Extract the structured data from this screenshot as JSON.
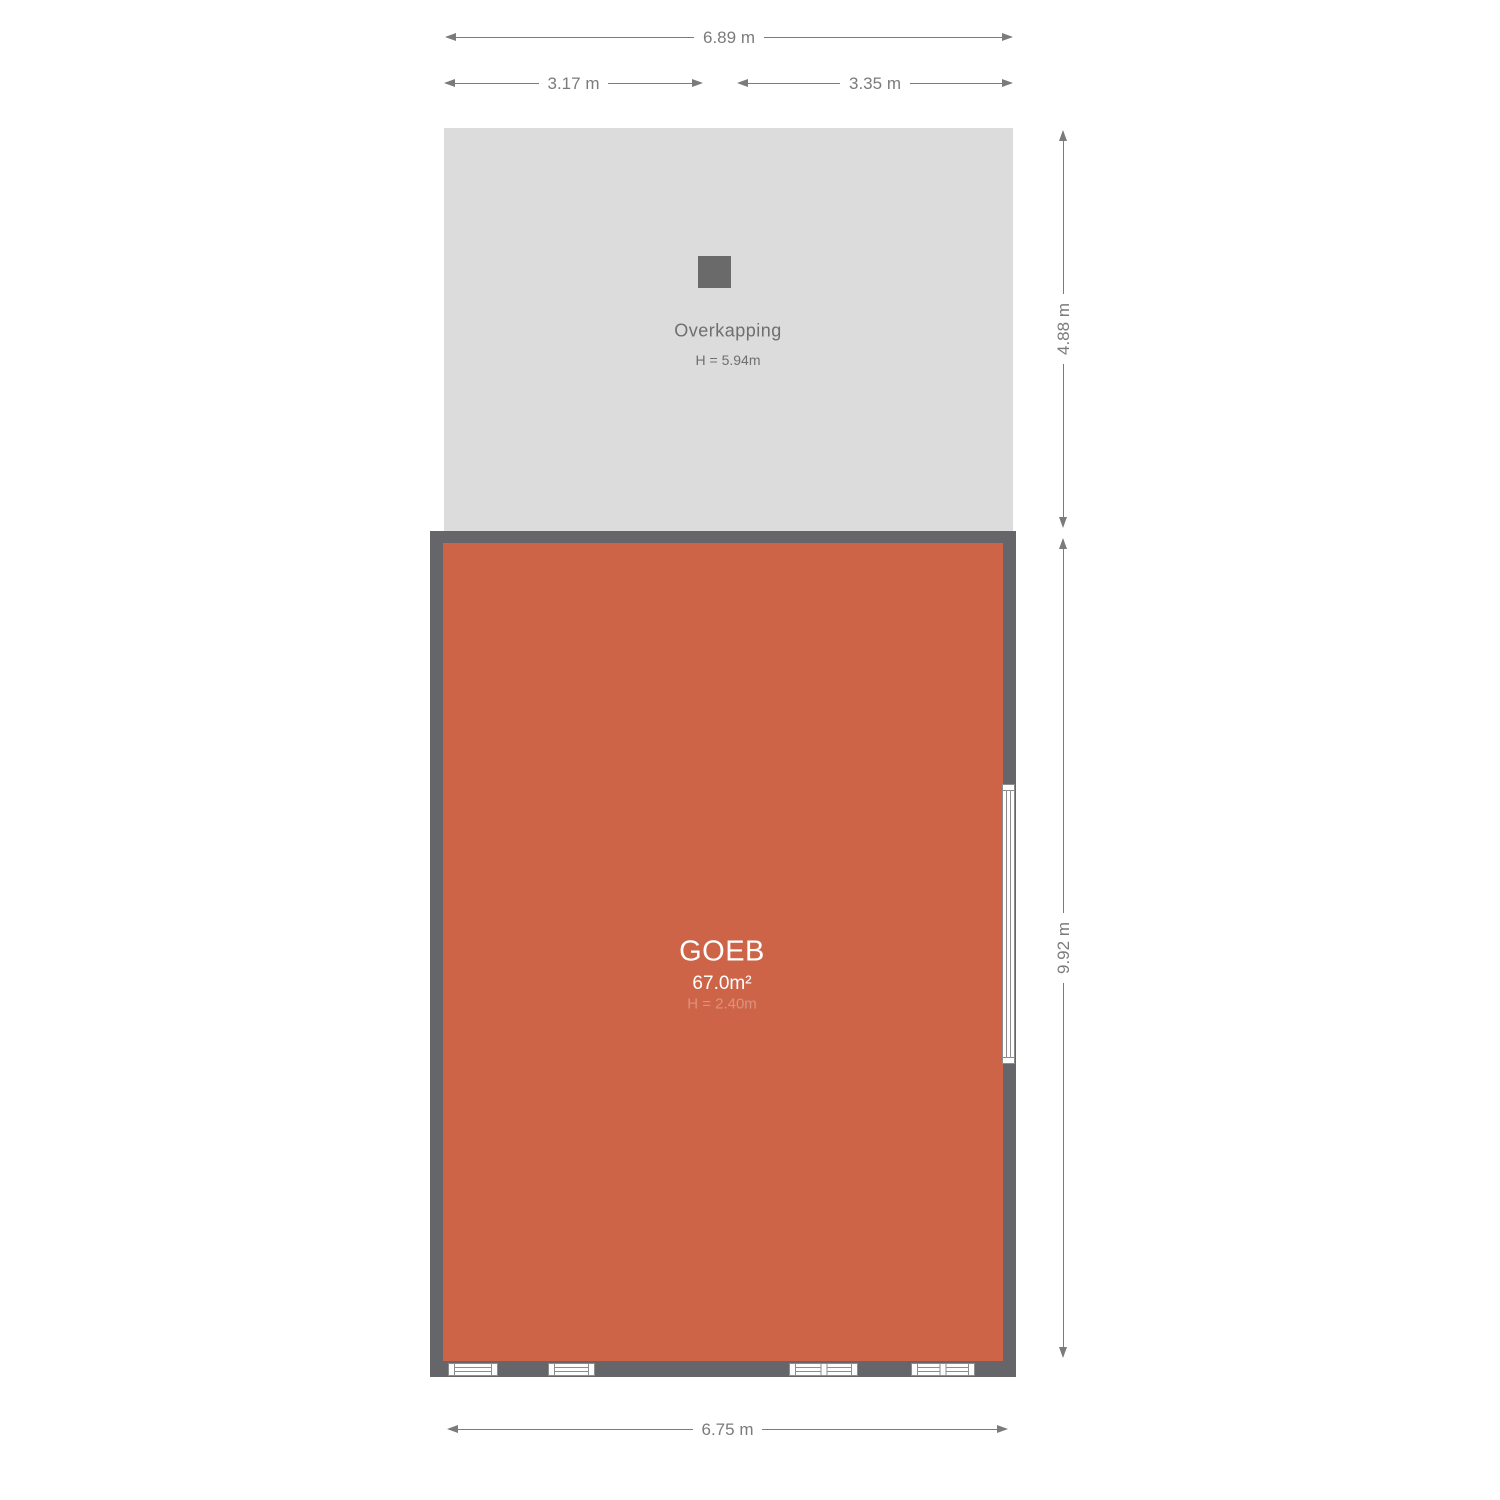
{
  "colors": {
    "room_fill": "#cd6448",
    "wall": "#66666a",
    "overkapping_fill": "#dcdcdc",
    "pillar": "#6a6a6a",
    "dim": "#7b7b7b",
    "window_line": "#8d8d8d"
  },
  "overkapping": {
    "name": "Overkapping",
    "height": "H = 5.94m"
  },
  "room": {
    "name": "GOEB",
    "area": "67.0m²",
    "height": "H = 2.40m"
  },
  "dimensions": {
    "top_total": "6.89 m",
    "top_left": "3.17 m",
    "top_right": "3.35 m",
    "side_upper": "4.88 m",
    "side_lower": "9.92 m",
    "bottom": "6.75 m"
  }
}
